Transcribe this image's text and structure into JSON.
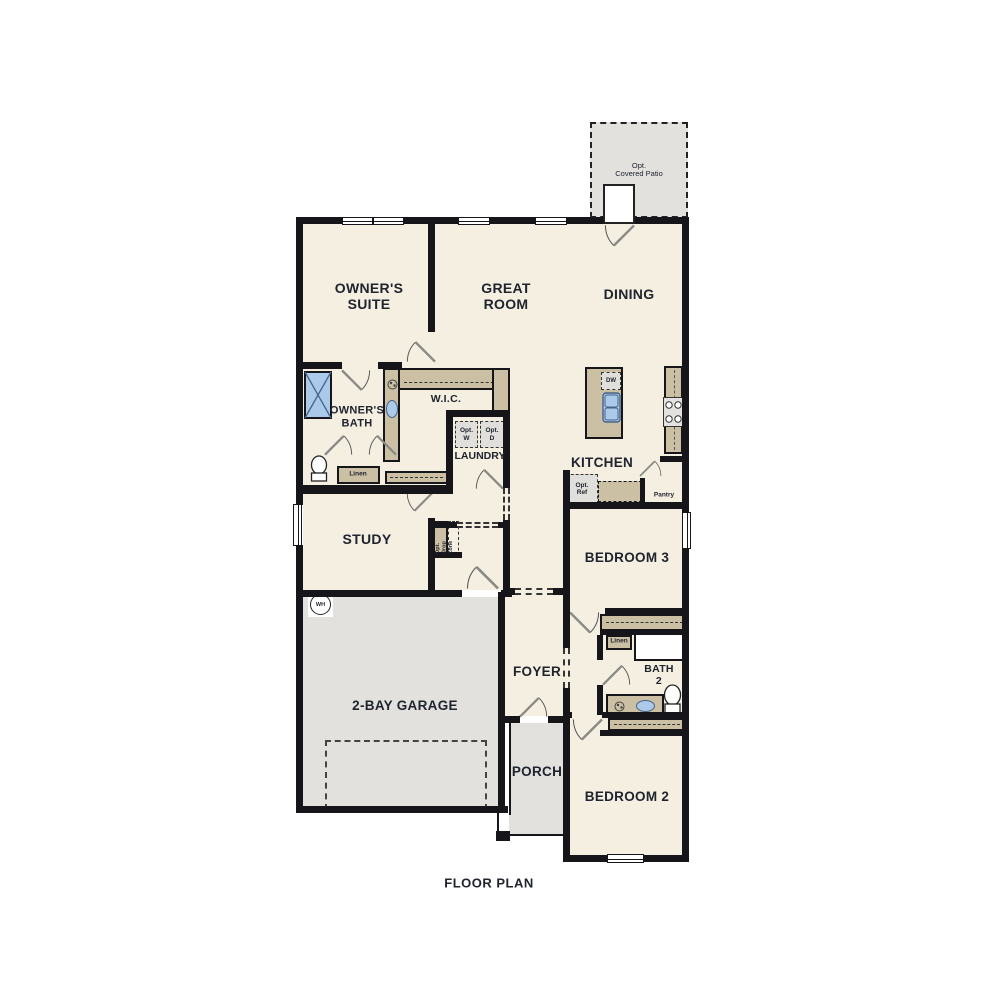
{
  "title": "FLOOR PLAN",
  "rooms": {
    "owners_suite": "OWNER'S\nSUITE",
    "great_room": "GREAT\nROOM",
    "dining": "DINING",
    "owners_bath": "OWNER'S\nBATH",
    "wic": "W.I.C.",
    "laundry": "LAUNDRY",
    "kitchen": "KITCHEN",
    "study": "STUDY",
    "bedroom3": "BEDROOM 3",
    "foyer": "FOYER",
    "bath2": "BATH\n2",
    "garage": "2-BAY GARAGE",
    "porch": "PORCH",
    "bedroom2": "BEDROOM 2"
  },
  "features": {
    "opt_covered_patio": "Opt.\nCovered Patio",
    "linen_owners": "Linen",
    "linen_bath2": "Linen",
    "opt_washer": "Opt.\nW",
    "opt_dryer": "Opt.\nD",
    "dishwasher": "DW",
    "opt_fridge": "Opt.\nRef",
    "pantry": "Pantry",
    "water_heater": "WH",
    "drop_zone": "Opt.\nDrop\nZone"
  },
  "colors": {
    "wall": "#16161a",
    "room": "#f5efe2",
    "tan": "#cbbfa4",
    "grey": "#e2e1de",
    "blue": "#abc9e9",
    "blue_border": "#46648a",
    "appliance": "#e0dfdc",
    "text": "#20242e",
    "leaf": "#8a8a84",
    "arc": "#555555"
  }
}
